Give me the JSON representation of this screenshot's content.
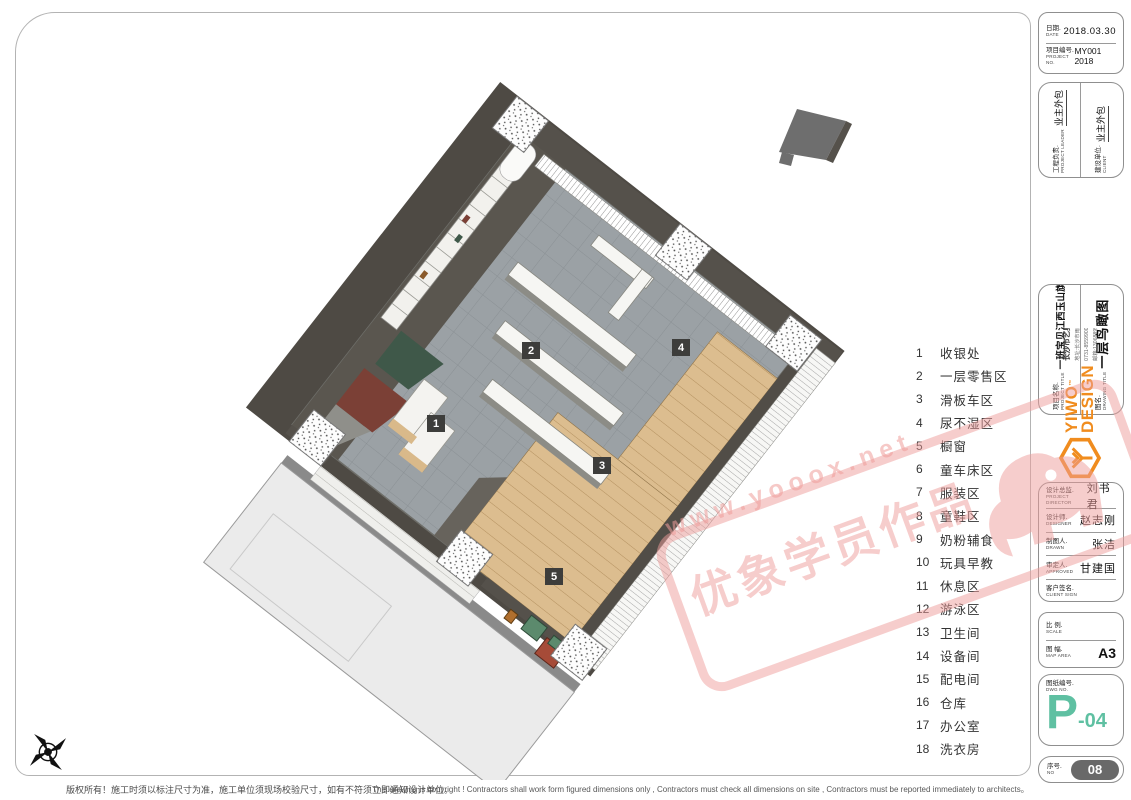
{
  "title_block": {
    "date_label_zh": "日期.",
    "date_label_en": "DATE",
    "date_value": "2018.03.30",
    "project_no_label_zh": "项目编号.",
    "project_no_label_en": "PROJECT No.",
    "project_no_value": "MY001 2018",
    "leader_label_zh": "工程负责.",
    "leader_label_en": "PROJECT LEADER",
    "leader_value": "业主外包",
    "client_label_zh": "建设单位.",
    "client_label_en": "CLIENT",
    "client_value": "业主外包",
    "project_title_label_zh": "项目名称.",
    "project_title_label_en": "PROJECT TITLE",
    "project_title_value": "一班宝贝江西玉山旗舰店",
    "drawing_title_label_zh": "图名.",
    "drawing_title_label_en": "DRAWING TITLE",
    "drawing_title_value": "一层鸟瞰图"
  },
  "logo": {
    "brand_line1": "YIWO",
    "brand_line2": "DESIGN",
    "tm": "™",
    "studio": "长沙市艺奥设计工作室",
    "address": "地址:长沙市雨花区 长沙大道东城国际1栋902室",
    "phone": "0731-85599001 手机:18973138262",
    "email": "邮箱:1306889502@QQ.com",
    "accent_color": "#f08c1e"
  },
  "signatures": {
    "rows": [
      {
        "zh": "设计总监.",
        "en": "PROJECT DIRECTOR",
        "value": "刘书君"
      },
      {
        "zh": "设计师.",
        "en": "DESIGNER",
        "value": "赵志刚"
      },
      {
        "zh": "制图人.",
        "en": "DRAWN",
        "value": "张洁"
      },
      {
        "zh": "审定人.",
        "en": "APPROVED",
        "value": "甘建国"
      },
      {
        "zh": "客户签名.",
        "en": "CLIENT SIGN",
        "value": ""
      }
    ]
  },
  "scale_block": {
    "scale_label_zh": "比 例.",
    "scale_label_en": "SCALE",
    "scale_value": "",
    "map_label_zh": "图 幅.",
    "map_label_en": "MAP AREA",
    "map_value": "A3"
  },
  "dwg_block": {
    "label_zh": "图纸编号.",
    "label_en": "DWG NO.",
    "number_big": "P",
    "number_small": "-04",
    "number_color": "#5fc0a2"
  },
  "serial_block": {
    "label_zh": "序号.",
    "label_en": "NO",
    "value": "08"
  },
  "legend": {
    "items": [
      {
        "no": "1",
        "label": "收银处"
      },
      {
        "no": "2",
        "label": "一层零售区"
      },
      {
        "no": "3",
        "label": "滑板车区"
      },
      {
        "no": "4",
        "label": "尿不湿区"
      },
      {
        "no": "5",
        "label": "橱窗"
      },
      {
        "no": "6",
        "label": "童车床区"
      },
      {
        "no": "7",
        "label": "服装区"
      },
      {
        "no": "8",
        "label": "童鞋区"
      },
      {
        "no": "9",
        "label": "奶粉辅食"
      },
      {
        "no": "10",
        "label": "玩具早教"
      },
      {
        "no": "11",
        "label": "休息区"
      },
      {
        "no": "12",
        "label": "游泳区"
      },
      {
        "no": "13",
        "label": "卫生间"
      },
      {
        "no": "14",
        "label": "设备间"
      },
      {
        "no": "15",
        "label": "配电间"
      },
      {
        "no": "16",
        "label": "仓库"
      },
      {
        "no": "17",
        "label": "办公室"
      },
      {
        "no": "18",
        "label": "洗衣房"
      }
    ]
  },
  "plan": {
    "markers": [
      "1",
      "2",
      "3",
      "4",
      "5"
    ]
  },
  "watermark": {
    "line1": "www.yooox.net",
    "line2": "优象学员作品",
    "color": "#ef9d9b"
  },
  "footer": {
    "disclaimer_zh": "版权所有！施工时须以标注尺寸为准，施工单位须现场校验尺寸，如有不符须立即通知设计单位。",
    "disclaimer_en": "This drawing is copyright ! Contractors shall work form figured dimensions only , Contractors must check all dimensions on site , Contractors must be reported immediately to architects。"
  }
}
